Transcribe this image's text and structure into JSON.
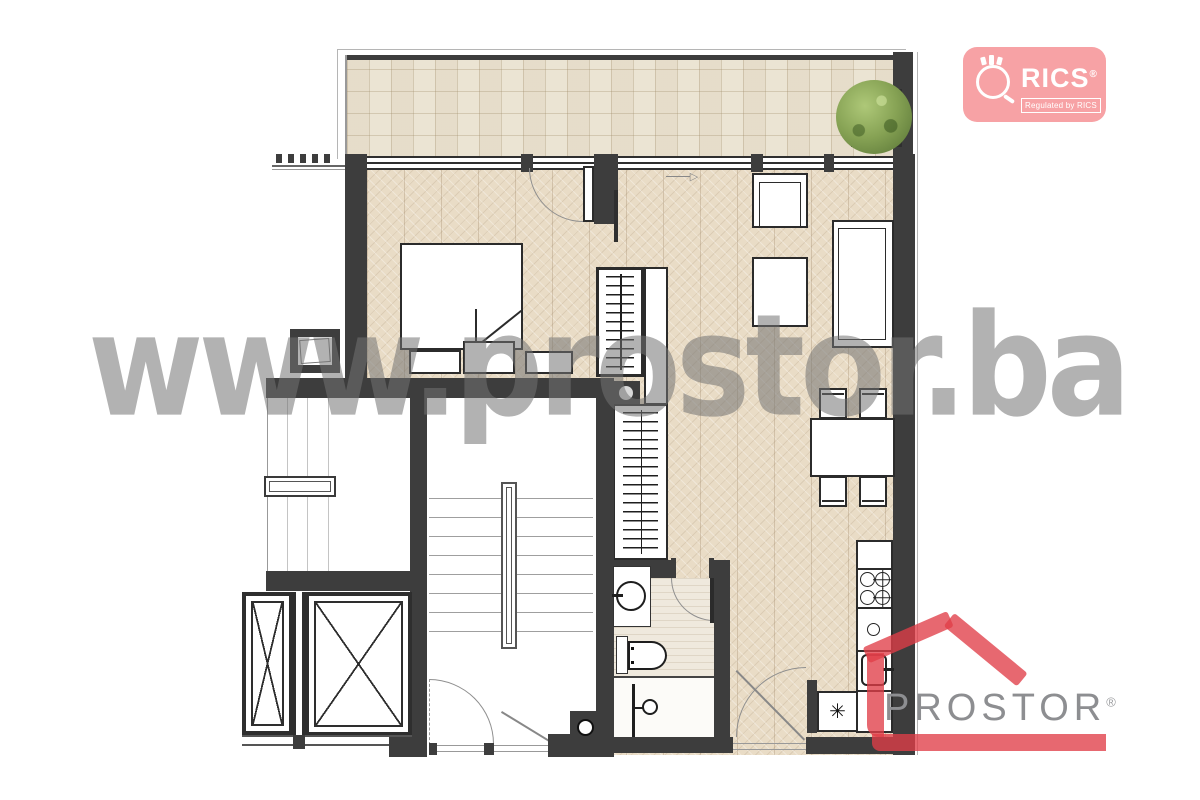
{
  "watermark": {
    "text": "www.prostor.ba",
    "color": "#757575"
  },
  "logos": {
    "rics": {
      "brand": "RICS",
      "reg_mark": "®",
      "tagline": "Regulated by RICS",
      "bg_color": "#F7A2A5",
      "text_color": "#FFFFFF"
    },
    "prostor": {
      "brand": "PROSTOR",
      "reg_mark": "®",
      "accent_color": "#E23E48",
      "text_color": "#8D8E91"
    }
  },
  "plan": {
    "colors": {
      "wall": "#3D3D3D",
      "wood_floor": "#E9DCC6",
      "terrace_tile": "#EBE4D3",
      "bath_tile": "#EFE9DD",
      "tree": "#86A254"
    },
    "icons": {
      "boiler_symbol": "✳",
      "entry_arrow": "▷"
    }
  }
}
